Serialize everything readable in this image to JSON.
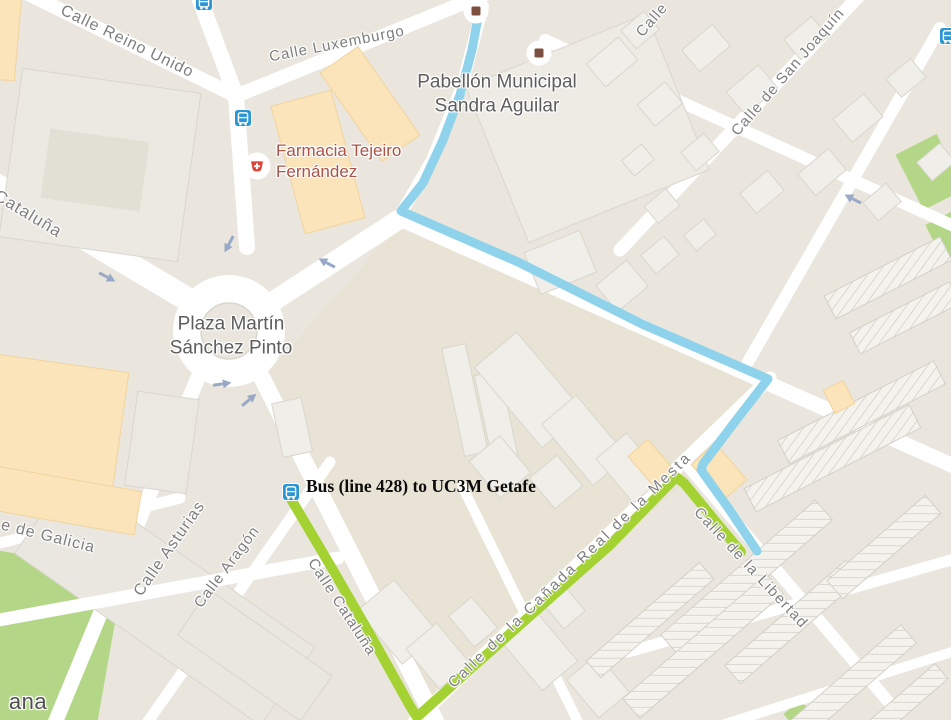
{
  "street_labels": {
    "reino_unido": "Calle Reino Unido",
    "luxemburgo": "Calle Luxemburgo",
    "cataluna_nw": "Cataluña",
    "san_joaquin": "Calle de San Joaquín",
    "calle_partial": "Calle",
    "galicia": "e de Galicia",
    "asturias": "Calle Asturias",
    "aragon": "Calle Aragón",
    "cataluna_se": "Calle Cataluña",
    "canada_real": "Calle de la Cañada Real de la Mesta",
    "libertad": "Calle de la Libertad",
    "locality_partial": "ana"
  },
  "poi_labels": {
    "pabellon_line1": "Pabellón Municipal",
    "pabellon_line2": "Sandra Aguilar",
    "plaza_line1": "Plaza Martín",
    "plaza_line2": "Sánchez Pinto",
    "farmacia_line1": "Farmacia Tejeiro",
    "farmacia_line2": "Fernández"
  },
  "annotation": {
    "bus_note": "Bus (line 428) to UC3M Getafe"
  },
  "routes": {
    "walking": {
      "label": "walking-route",
      "color": "#8ed2ec"
    },
    "bus_428": {
      "label": "bus-428-route",
      "color": "#a4d233"
    }
  },
  "icons": {
    "bus_stop": {
      "name": "bus-stop-icon",
      "color": "#2b96d4"
    },
    "poi_marker": {
      "name": "poi-square-marker",
      "color": "#7c4f3f"
    },
    "pharmacy": {
      "name": "pharmacy-icon",
      "color": "#dc4437"
    },
    "one_way_arrow": {
      "name": "one-way-arrow",
      "color": "#98a8c6"
    }
  }
}
